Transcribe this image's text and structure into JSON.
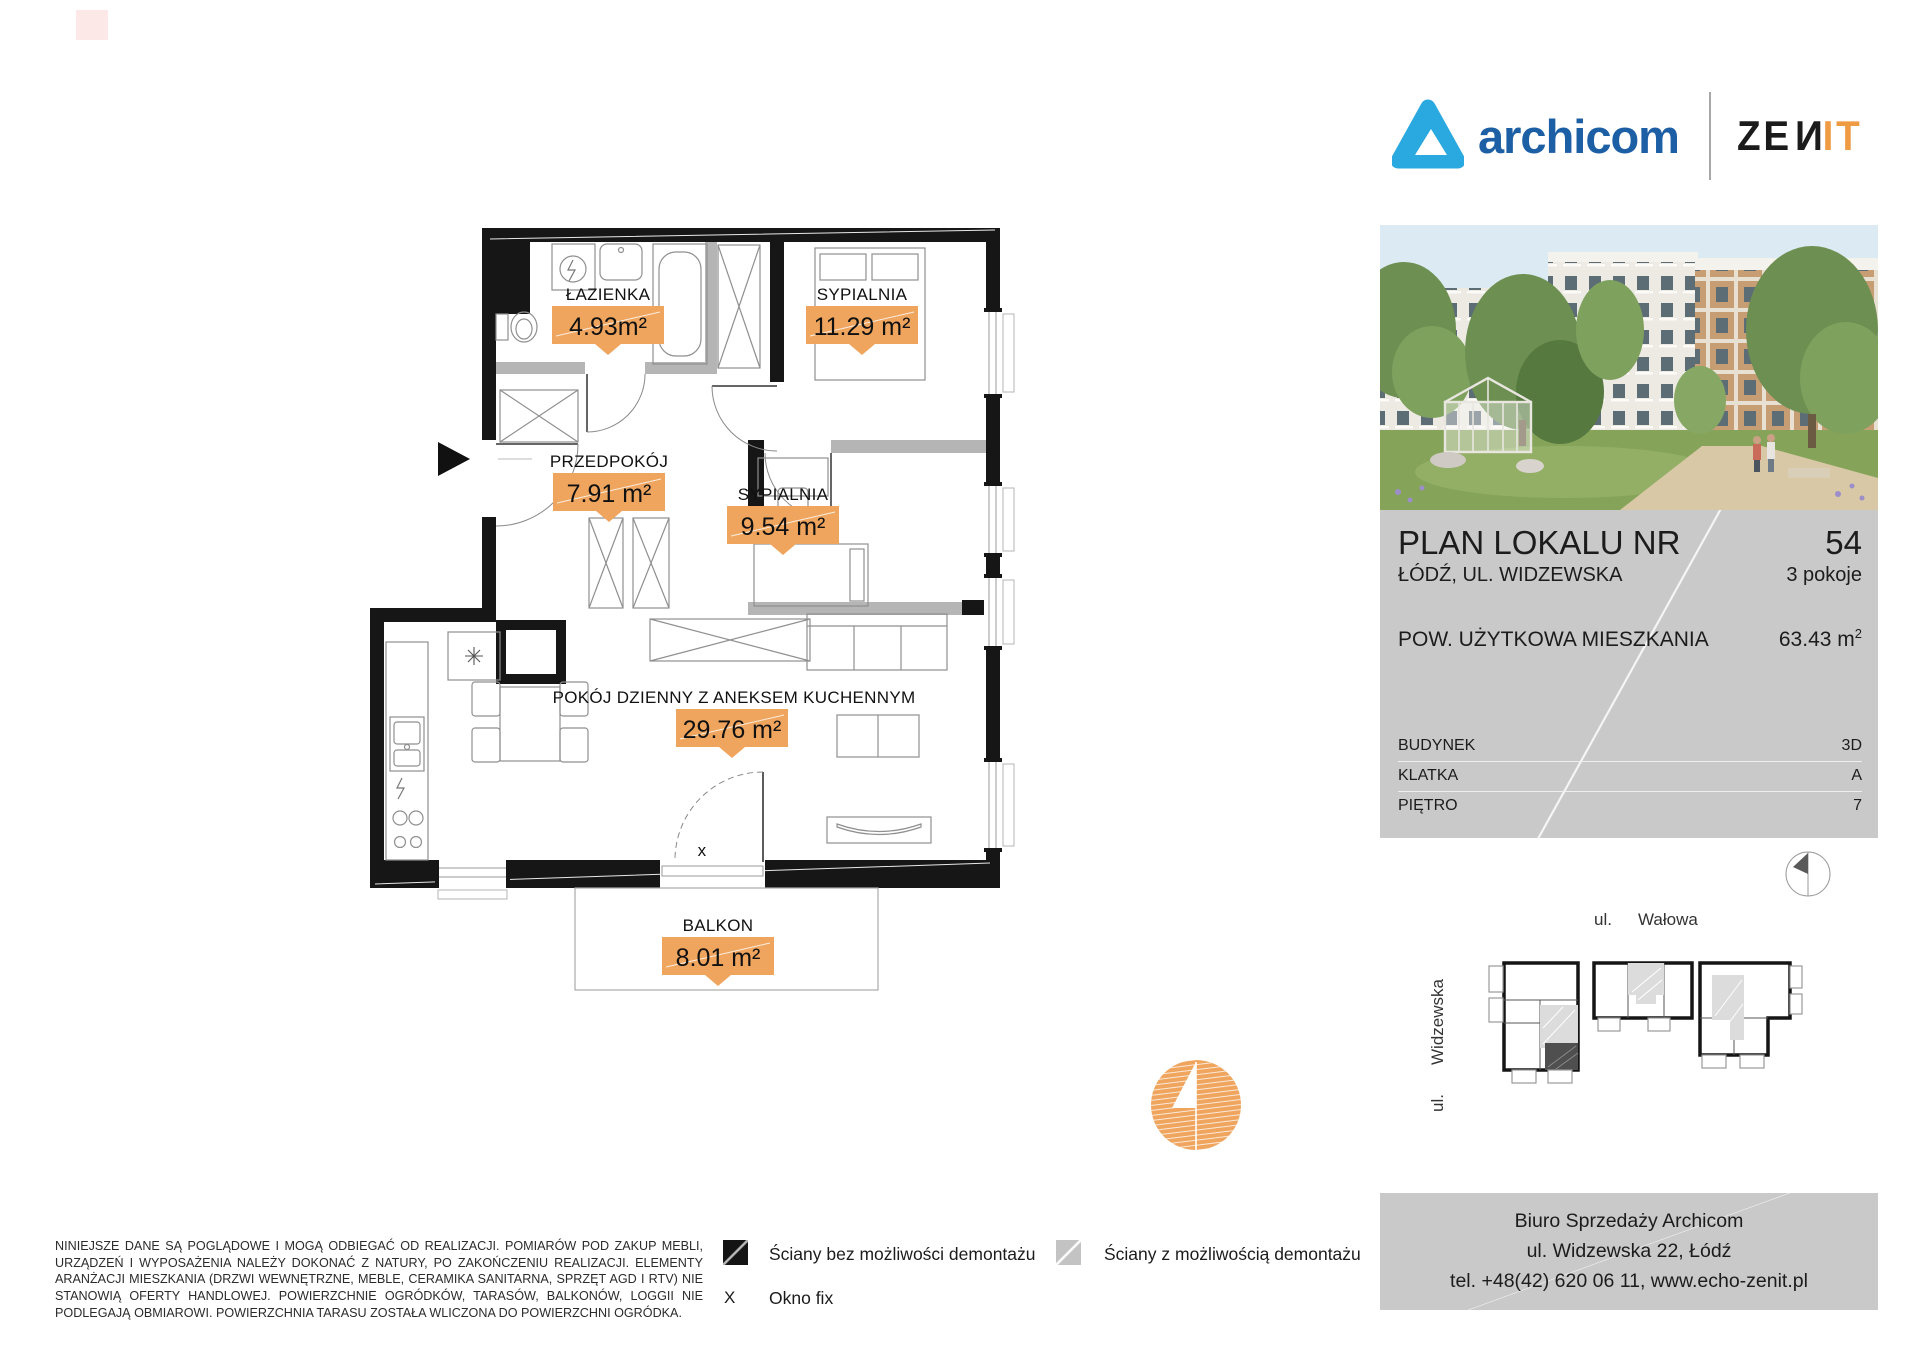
{
  "brand": {
    "name": "archicom",
    "zenit": {
      "left": "ZE",
      "mid": "N",
      "right": "IT"
    }
  },
  "floor_plan": {
    "rooms": [
      {
        "name": "ŁAZIENKA",
        "area": "4.93m²"
      },
      {
        "name": "SYPIALNIA",
        "area": "11.29 m²"
      },
      {
        "name": "PRZEDPOKÓJ",
        "area": "7.91 m²"
      },
      {
        "name": "SYPIALNIA",
        "area": "9.54 m²"
      },
      {
        "name": "POKÓJ DZIENNY Z ANEKSEM KUCHENNYM",
        "area": "29.76 m²"
      },
      {
        "name": "BALKON",
        "area": "8.01 m²"
      }
    ],
    "fixed_window_marker": "x"
  },
  "info_panel": {
    "title": "PLAN LOKALU NR",
    "unit_number": "54",
    "address": "ŁÓDŹ, UL. WIDZEWSKA",
    "rooms_count": "3 pokoje",
    "area_label": "POW. UŻYTKOWA MIESZKANIA",
    "area_value": "63.43 m",
    "area_sup": "2",
    "attrs": [
      {
        "label": "BUDYNEK",
        "value": "3D"
      },
      {
        "label": "KLATKA",
        "value": "A"
      },
      {
        "label": "PIĘTRO",
        "value": "7"
      }
    ]
  },
  "site_map": {
    "street_top_prefix": "ul.",
    "street_top_name": "Wałowa",
    "street_left_prefix": "ul.",
    "street_left_name": "Widzewska"
  },
  "legend": {
    "solid_walls": "Ściany bez możliwości demontażu",
    "removable_walls": "Ściany z możliwością demontażu",
    "window_symbol": "X",
    "window_label": "Okno fix"
  },
  "disclaimer": "NINIEJSZE DANE SĄ POGLĄDOWE I MOGĄ ODBIEGAĆ OD REALIZACJI. POMIARÓW POD ZAKUP MEBLI, URZĄDZEŃ I WYPOSAŻENIA NALEŻY DOKONAĆ Z NATURY, PO ZAKOŃCZENIU REALIZACJI. ELEMENTY ARANŻACJI MIESZKANIA (DRZWI WEWNĘTRZNE, MEBLE, CERAMIKA SANITARNA, SPRZĘT AGD I RTV) NIE STANOWIĄ OFERTY HANDLOWEJ. POWIERZCHNIE OGRÓDKÓW, TARASÓW, BALKONÓW, LOGGII NIE PODLEGAJĄ OBMIAROWI. POWIERZCHNIA TARASU ZOSTAŁA WLICZONA DO POWIERZCHNI OGRÓDKA.",
  "contact": {
    "line1": "Biuro Sprzedaży Archicom",
    "line2": "ul. Widzewska 22, Łódź",
    "line3": "tel. +48(42) 620 06 11, www.echo-zenit.pl"
  },
  "colors": {
    "accent_orange": "#EFA55E",
    "archicom_blue": "#1D5FA5",
    "archicom_cyan": "#29A9E0",
    "zenit_orange": "#EF9B44",
    "panel_gray": "#C9C9C9"
  }
}
